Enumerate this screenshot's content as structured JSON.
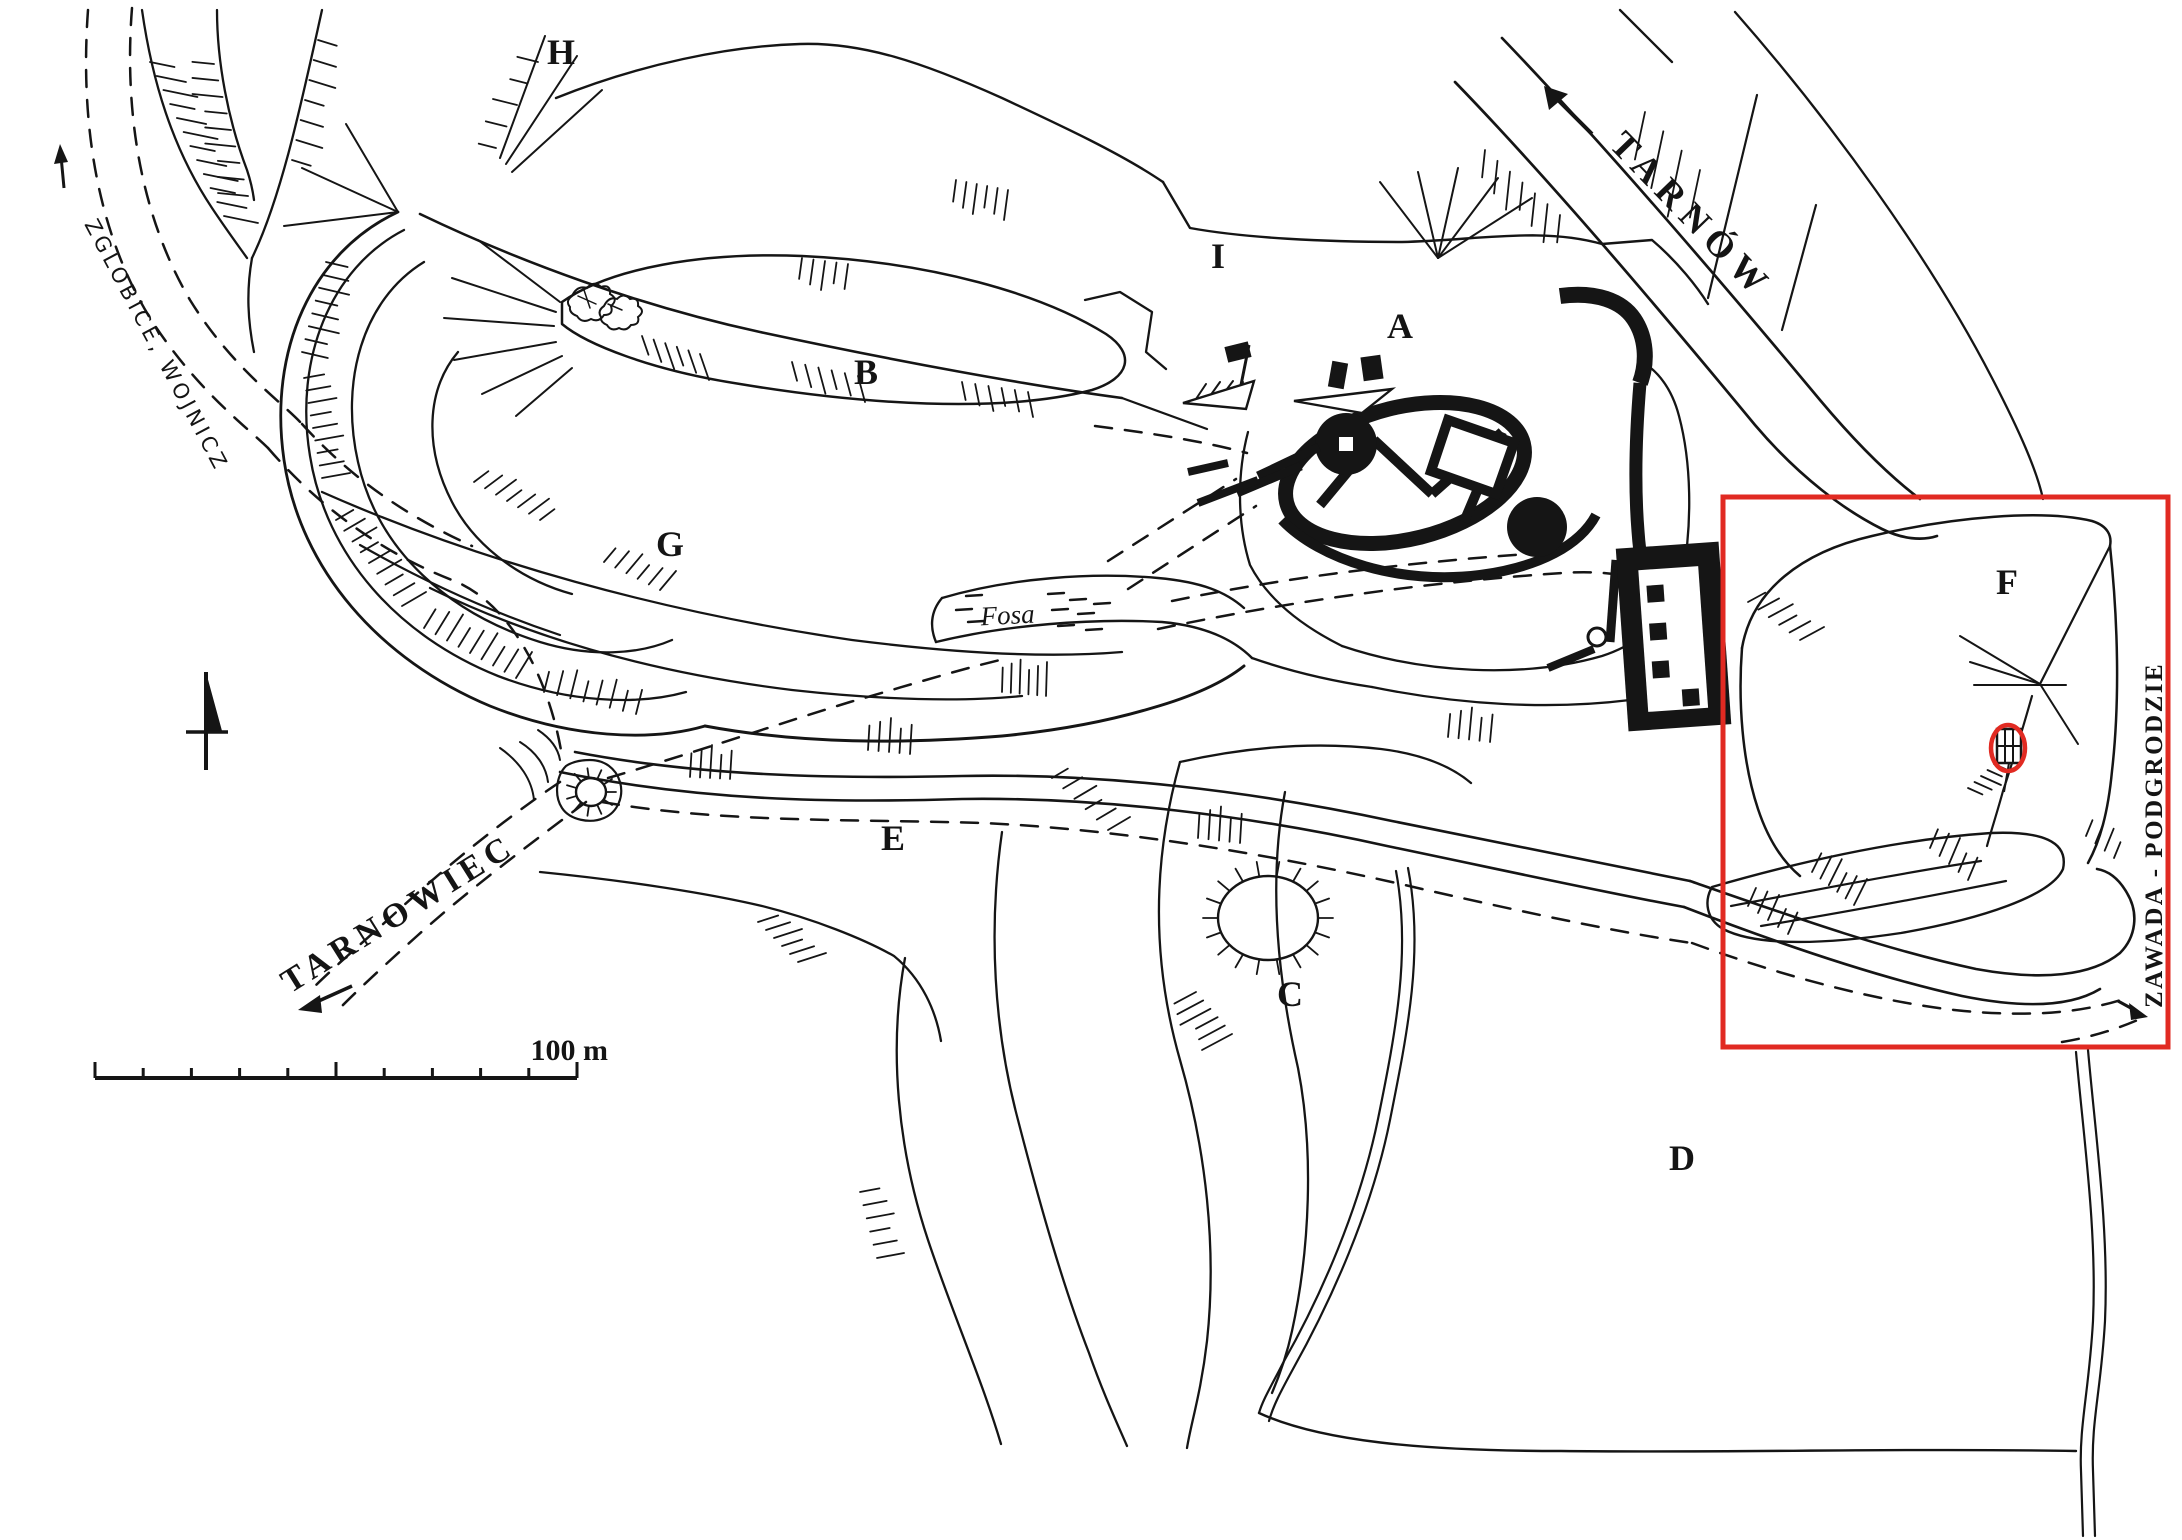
{
  "map_labels": {
    "areas": [
      "A",
      "B",
      "C",
      "D",
      "E",
      "F",
      "G",
      "H",
      "I"
    ],
    "roads": {
      "tarnow": "TARNÓW",
      "zglobice_wojnicz": "ZGLOBICE, WOJNICZ",
      "tarnowiec": "TARNOWIEC",
      "zawada_podgrodzie": "ZAWADA - PODGRODZIE"
    },
    "moat": "Fosa",
    "scale_bar": "100 m"
  },
  "colors": {
    "ink": "#151515",
    "highlight_red": "#e12a22",
    "paper": "#ffffff"
  }
}
